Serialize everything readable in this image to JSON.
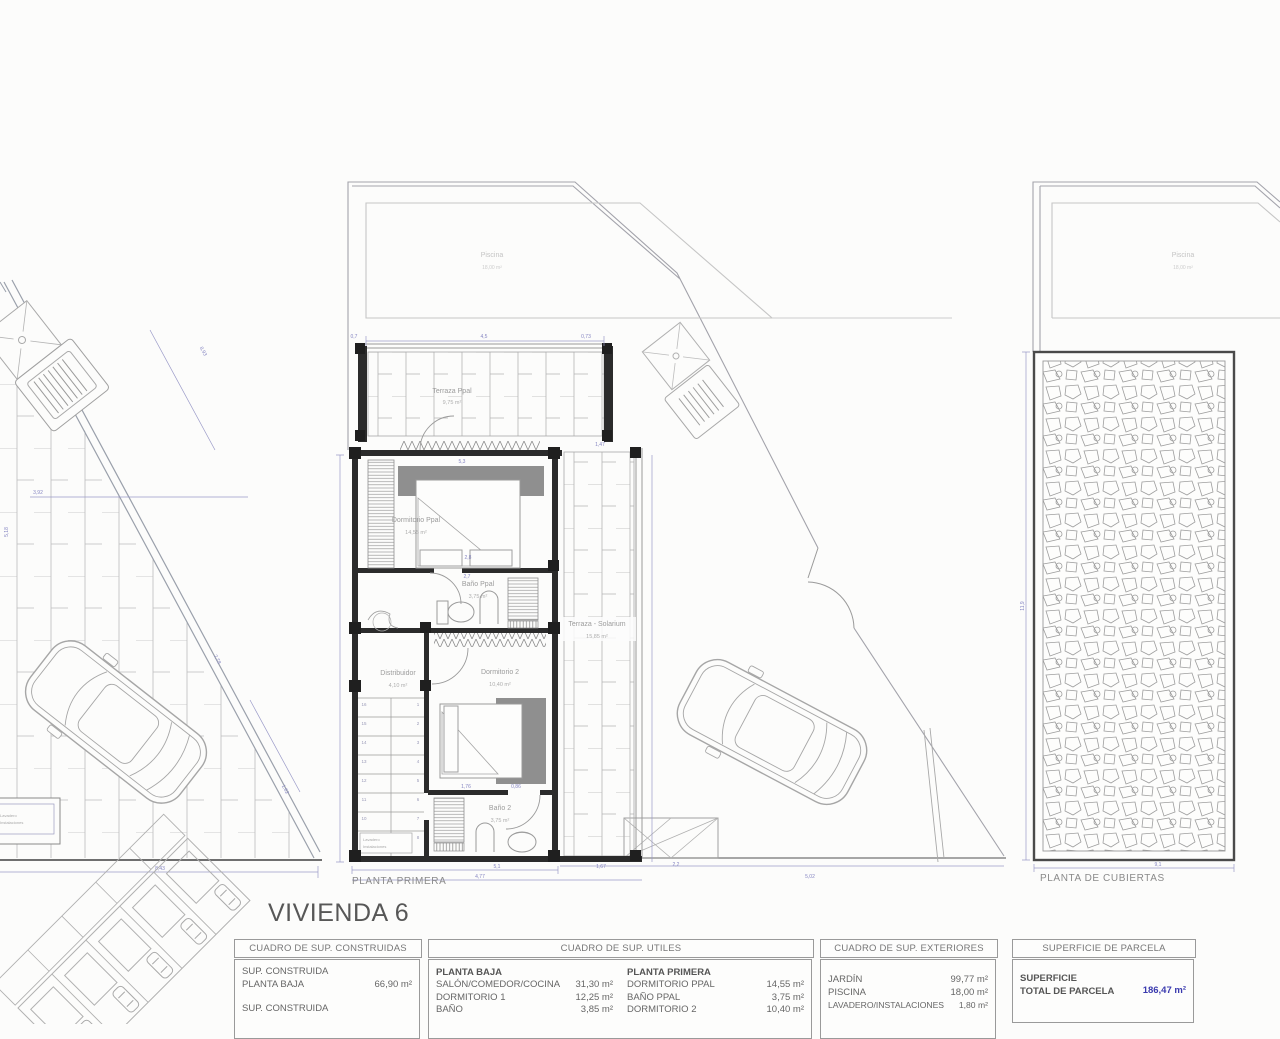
{
  "title": "VIVIENDA 6",
  "plan_labels": {
    "first_floor": "PLANTA PRIMERA",
    "roof": "PLANTA DE CUBIERTAS"
  },
  "rooms": {
    "piscina": {
      "name": "Piscina",
      "area": "18,00 m²"
    },
    "terraza_ppal": {
      "name": "Terraza Ppal",
      "area": "9,75 m²"
    },
    "dormitorio_ppal": {
      "name": "Dormitorio Ppal",
      "area": "14,55 m²"
    },
    "bano_ppal": {
      "name": "Baño Ppal",
      "area": "3,75 m²"
    },
    "distribuidor": {
      "name": "Distribuidor",
      "area": "4,10 m²"
    },
    "dormitorio_2": {
      "name": "Dormitorio 2",
      "area": "10,40 m²"
    },
    "bano_2": {
      "name": "Baño 2",
      "area": "3,75 m²"
    },
    "terraza_solarium": {
      "name": "Terraza - Solarium",
      "area": "15,85 m²"
    },
    "lavadero": {
      "line1": "Lavadero",
      "line2": "Instalaciones"
    }
  },
  "stairs": {
    "left": [
      "16",
      "15",
      "14",
      "13",
      "12",
      "11",
      "10",
      "9"
    ],
    "right": [
      "1",
      "2",
      "3",
      "4",
      "5",
      "6",
      "7",
      "8"
    ]
  },
  "dims": [
    "4,5",
    "0,7",
    "0,73",
    "5,3",
    "2,8",
    "2,7",
    "1,76",
    "0,86",
    "5,1",
    "1,67",
    "4,77",
    "2,2",
    "5,02",
    "1,47",
    "8,93",
    "3,92",
    "5,18",
    "8,43",
    "1,62",
    "7,78",
    "11,9",
    "9,1"
  ],
  "tables": {
    "construidas": {
      "title": "CUADRO DE SUP. CONSTRUIDAS",
      "row1_label": "SUP. CONSTRUIDA",
      "row2_label": "PLANTA BAJA",
      "row2_value": "66,90 m²",
      "row3_label": "SUP. CONSTRUIDA"
    },
    "utiles": {
      "title": "CUADRO DE SUP. UTILES",
      "col1": {
        "heading": "PLANTA BAJA",
        "rows": [
          [
            "SALÓN/COMEDOR/COCINA",
            "31,30 m²"
          ],
          [
            "DORMITORIO 1",
            "12,25 m²"
          ],
          [
            "BAÑO",
            "3,85 m²"
          ]
        ]
      },
      "col2": {
        "heading": "PLANTA PRIMERA",
        "rows": [
          [
            "DORMITORIO PPAL",
            "14,55 m²"
          ],
          [
            "BAÑO PPAL",
            "3,75 m²"
          ],
          [
            "DORMITORIO 2",
            "10,40 m²"
          ]
        ]
      }
    },
    "exteriores": {
      "title": "CUADRO DE SUP. EXTERIORES",
      "rows": [
        [
          "JARDÍN",
          "99,77 m²"
        ],
        [
          "PISCINA",
          "18,00 m²"
        ],
        [
          "LAVADERO/INSTALACIONES",
          "1,80 m²"
        ]
      ]
    },
    "parcela": {
      "title": "SUPERFICIE DE PARCELA",
      "label_line1": "SUPERFICIE",
      "label_line2": "TOTAL DE PARCELA",
      "value": "186,47 m²"
    }
  },
  "colors": {
    "dim_blue": "#8585c2",
    "value_blue": "#3a3aae",
    "wall": "#2b2b2b",
    "line": "#a0a0a0"
  }
}
